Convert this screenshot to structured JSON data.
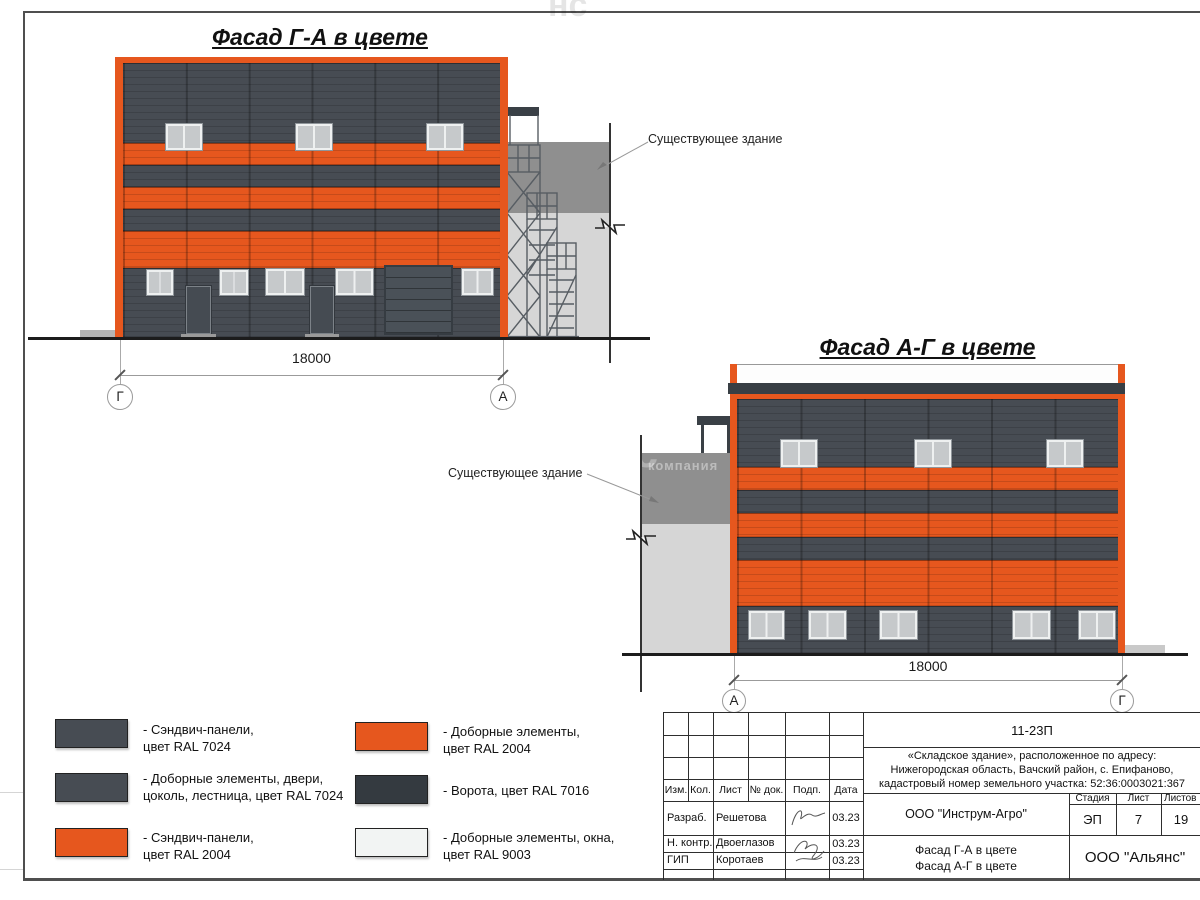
{
  "colors": {
    "ral2004": "#E6571E",
    "ral7024": "#474C53",
    "ral7016": "#343A40",
    "ral9003": "#F2F4F3",
    "existdark": "#8F8F8F",
    "existlight": "#D6D6D6"
  },
  "facade1": {
    "title": "Фасад Г-А в цвете",
    "existing_label": "Существующее здание",
    "dimension": "18000",
    "axis_left": "Г",
    "axis_right": "А"
  },
  "facade2": {
    "title": "Фасад А-Г в цвете",
    "existing_label": "Существующее здание",
    "dimension": "18000",
    "axis_left": "А",
    "axis_right": "Г"
  },
  "legend": {
    "items": [
      {
        "color_key": "ral7024",
        "label": "- Сэндвич-панели,\nцвет RAL 7024"
      },
      {
        "color_key": "ral7024",
        "label": "- Доборные элементы, двери,\nцоколь, лестница, цвет RAL 7024"
      },
      {
        "color_key": "ral2004",
        "label": "- Сэндвич-панели,\nцвет RAL 2004"
      },
      {
        "color_key": "ral2004",
        "label": "- Доборные элементы,\nцвет RAL 2004"
      },
      {
        "color_key": "ral7016",
        "label": "- Ворота, цвет RAL 7016"
      },
      {
        "color_key": "ral9003",
        "label": "- Доборные элементы, окна,\nцвет RAL 9003"
      }
    ]
  },
  "titleblock": {
    "code": "11-23П",
    "address": "«Складское здание», расположенное по адресу:\nНижегородская область, Вачский район, с. Епифаново,\nкадастровый номер земельного участка: 52:36:0003021:367",
    "rev_headers": {
      "izm": "Изм.",
      "kol": "Кол.",
      "list": "Лист",
      "doc": "№ док.",
      "podp": "Подп.",
      "data": "Дата"
    },
    "rows": [
      {
        "role": "Разраб.",
        "name": "Решетова",
        "date": "03.23"
      },
      {
        "role": "Н. контр.",
        "name": "Двоеглазов",
        "date": "03.23"
      },
      {
        "role": "ГИП",
        "name": "Коротаев",
        "date": "03.23"
      }
    ],
    "org1": "ООО \"Инструм-Агро\"",
    "subject": "Фасад Г-А в цвете\nФасад А-Г в цвете",
    "stage_headers": {
      "stage": "Стадия",
      "sheet": "Лист",
      "sheets": "Листов"
    },
    "stage_values": {
      "stage": "ЭП",
      "sheet": "7",
      "sheets": "19"
    },
    "org2": "ООО \"Альянс\""
  },
  "watermark": {
    "large": "нс",
    "small": "компания"
  }
}
